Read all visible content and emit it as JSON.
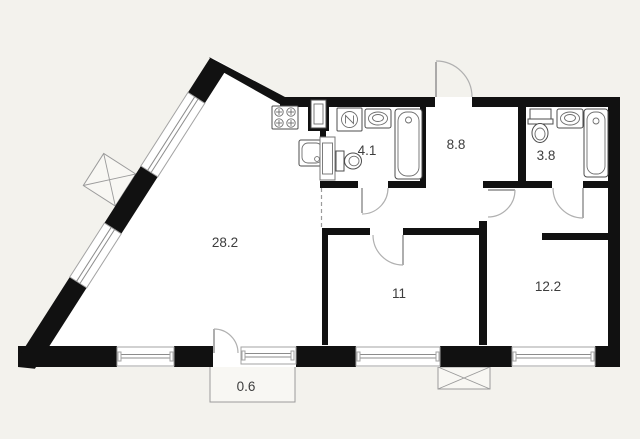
{
  "plan": {
    "type": "apartment-floor-plan",
    "rooms": {
      "living_kitchen": {
        "name": "living-kitchen",
        "area": "28.2"
      },
      "bathroom_1": {
        "name": "bathroom",
        "area": "4.1"
      },
      "hallway": {
        "name": "hallway",
        "area": "8.8"
      },
      "bathroom_2": {
        "name": "bathroom-2",
        "area": "3.8"
      },
      "bedroom_1": {
        "name": "bedroom",
        "area": "11"
      },
      "bedroom_2": {
        "name": "bedroom-2",
        "area": "12.2"
      },
      "balcony": {
        "name": "balcony",
        "area": "0.6"
      }
    },
    "fixtures": {
      "kitchen": [
        "stove",
        "kitchen-cabinet",
        "kitchen-sink"
      ],
      "bathroom_1": [
        "washing-machine",
        "sink",
        "bathtub",
        "toilet",
        "duct-shaft"
      ],
      "bathroom_2": [
        "toilet",
        "sink",
        "bathtub"
      ]
    },
    "symbols": [
      "ventilation-shaft-diagonal",
      "ventilation-shaft-bottom"
    ],
    "counts": {
      "windows": 6,
      "doors": 6
    },
    "colors": {
      "wall": "#111111",
      "interior": "#ffffff",
      "page_background": "#f3f2ed",
      "thin_line": "#9b9b9b",
      "fixture_line": "#4d4d4d",
      "label_text": "#3d3d3d"
    }
  }
}
